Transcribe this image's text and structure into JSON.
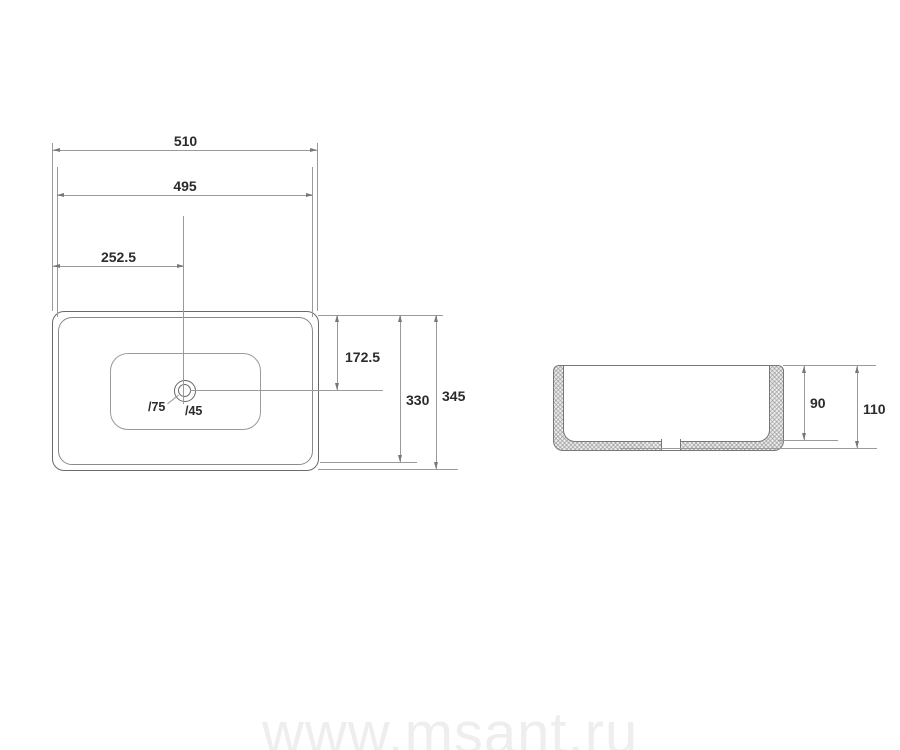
{
  "views": {
    "top": {
      "dim_width_outer": "510",
      "dim_width_inner": "495",
      "dim_drain_from_left": "252.5",
      "dim_drain_from_top": "172.5",
      "dim_depth_inner": "330",
      "dim_depth_outer": "345",
      "label_drain_outer": "/75",
      "label_drain_inner": "/45"
    },
    "side": {
      "dim_bowl_depth": "90",
      "dim_total_height": "110"
    }
  },
  "watermark": {
    "text": "www.msant.ru"
  },
  "colors": {
    "background": "#ffffff",
    "outline": "#6a6a6a",
    "thin_line": "#9a9a9a",
    "text": "#2b2b2b",
    "hatch_fill": "#ececec",
    "watermark": "#eeeeee"
  }
}
